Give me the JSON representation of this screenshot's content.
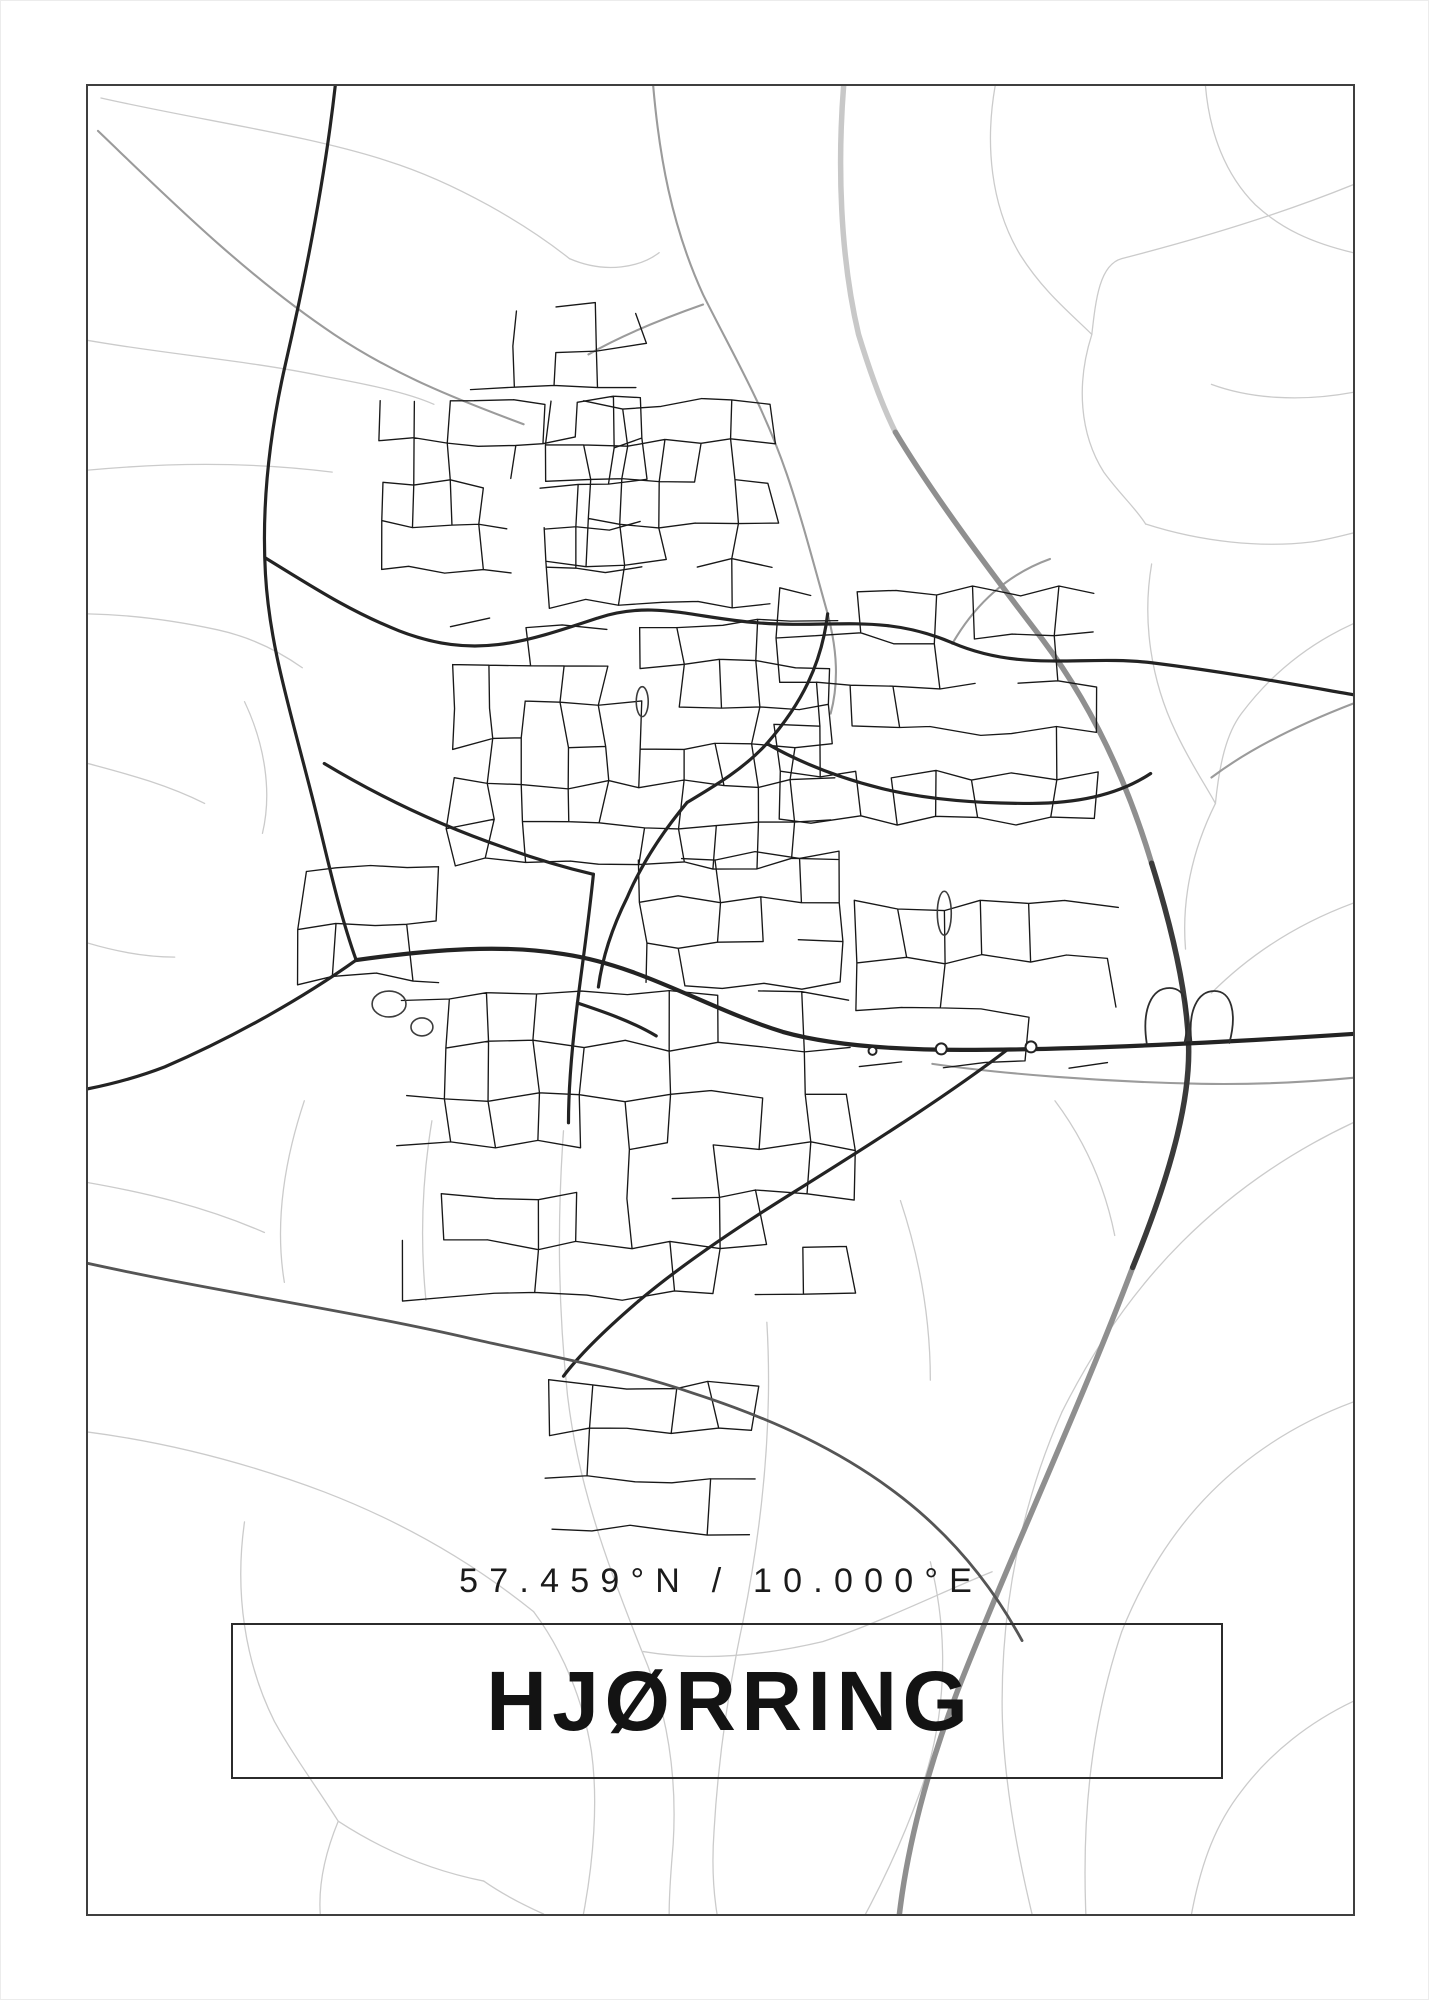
{
  "poster": {
    "title": "HJØRRING",
    "coordinates": "57.459°N / 10.000°E",
    "colors": {
      "background": "#ffffff",
      "frame_border": "#3f3f3f",
      "title_box_border": "#2b2b2b",
      "title_text": "#131313",
      "coordinates_text": "#1b1b1b",
      "road_faint": "#cbcbcb",
      "road_medium": "#9b9b9b",
      "road_dark": "#232323",
      "motorway_dark": "#3a3a3a"
    },
    "map": {
      "viewbox": "85 83 1269 1832",
      "layers": [
        {
          "name": "rural-faint",
          "color": "#cbcbcb",
          "width": 1.3,
          "paths": [
            "M98,95 C200,118 305,132 385,158 C455,180 525,222 568,256",
            "M568,256 C605,272 640,264 658,250",
            "M85,338 C165,352 245,358 322,374 C365,382 405,390 432,402",
            "M85,468 C170,460 252,460 330,470",
            "M85,612 C135,613 178,620 215,628 C252,636 280,652 300,666",
            "M242,700 C262,742 270,790 260,832",
            "M85,762 C122,772 162,782 202,802",
            "M995,83 C985,140 990,202 1020,252 C1044,290 1072,312 1092,332",
            "M1354,182 C1280,212 1200,236 1122,256 C1100,262 1096,296 1092,332",
            "M1092,332 C1076,382 1080,432 1104,470 C1120,492 1136,506 1146,522",
            "M1206,83 C1210,130 1226,172 1256,202 C1282,226 1312,240 1354,250",
            "M1354,390 C1300,400 1250,396 1212,382",
            "M1146,522 C1202,540 1262,546 1312,540 C1327,538 1342,534 1354,531",
            "M1152,562 C1142,620 1152,680 1176,730 C1190,760 1205,782 1216,802",
            "M1354,622 C1310,642 1272,672 1242,712 C1227,732 1220,762 1216,802",
            "M1216,802 C1192,850 1182,900 1186,948",
            "M302,1100 C282,1160 272,1222 282,1282",
            "M85,1182 C142,1192 202,1206 262,1232",
            "M85,1432 C162,1442 242,1462 322,1492 C400,1522 470,1562 532,1612",
            "M242,1522 C232,1592 242,1662 272,1722 C292,1758 316,1790 336,1822",
            "M336,1822 C382,1852 432,1872 482,1882 M336,1822 C322,1856 316,1886 318,1915",
            "M532,1612 C562,1652 582,1702 590,1752 C597,1802 592,1862 582,1915",
            "M482,1882 C502,1896 522,1906 542,1915",
            "M562,1130 C556,1215 556,1300 566,1395 C576,1480 602,1555 640,1650",
            "M640,1650 C668,1715 676,1780 672,1845 C670,1868 668,1892 668,1915",
            "M766,1322 C772,1422 762,1522 742,1622 C727,1692 717,1762 713,1832 C711,1860 712,1890 716,1915",
            "M1354,902 C1300,922 1252,952 1212,992",
            "M1354,1122 C1290,1152 1232,1192 1182,1242 C1132,1292 1092,1352 1062,1412",
            "M1062,1412 C1022,1502 1002,1602 1002,1702 C1002,1762 1012,1832 1032,1915",
            "M1354,1402 C1300,1422 1252,1452 1212,1492 C1172,1532 1142,1582 1122,1632",
            "M1122,1632 C1092,1722 1082,1812 1086,1915",
            "M1354,1702 C1312,1722 1272,1752 1242,1792 C1217,1824 1202,1862 1192,1915",
            "M642,1652 C702,1662 762,1656 822,1642 C882,1622 942,1592 992,1572",
            "M85,942 C112,950 142,956 172,956",
            "M430,1120 C420,1180 418,1240 424,1300",
            "M900,1200 C920,1260 930,1320 930,1380",
            "M1055,1100 C1085,1140 1105,1185 1115,1235",
            "M930,1562 C950,1642 945,1722 920,1792 C900,1847 880,1887 865,1915"
          ]
        },
        {
          "name": "connector-medium",
          "color": "#9b9b9b",
          "width": 2.1,
          "paths": [
            "M652,83 C658,152 670,222 702,292 C732,352 762,402 786,472 C801,516 813,562 827,612 C837,650 838,682 830,712",
            "M95,128 C162,192 242,272 332,332 C392,372 452,396 522,422",
            "M1354,702 C1302,722 1252,746 1212,776",
            "M932,1063 C1002,1073 1102,1081 1202,1083 C1262,1084 1312,1081 1354,1077",
            "M702,302 C662,316 622,332 587,352",
            "M952,642 C975,602 1008,572 1050,557"
          ]
        },
        {
          "name": "motorway-light",
          "color": "#c8c8c8",
          "width": 5.5,
          "paths": [
            "M843,83 C837,160 839,252 858,332 C869,368 881,402 895,430"
          ]
        },
        {
          "name": "motorway-mid",
          "color": "#8f8f8f",
          "width": 5.5,
          "paths": [
            "M895,430 C932,492 992,572 1042,637 C1082,690 1122,762 1152,862",
            "M1133,1267 C1082,1402 1012,1552 957,1692 C927,1770 907,1847 899,1915"
          ]
        },
        {
          "name": "residential-streets",
          "color": "#181818",
          "width": 1.35,
          "clusters": [
            {
              "x": 378,
              "y": 398,
              "w": 265,
              "h": 168,
              "rows": 4,
              "cols": 8,
              "seed": 11
            },
            {
              "x": 548,
              "y": 402,
              "w": 225,
              "h": 200,
              "rows": 5,
              "cols": 6,
              "seed": 22
            },
            {
              "x": 448,
              "y": 622,
              "w": 385,
              "h": 240,
              "rows": 6,
              "cols": 10,
              "seed": 33
            },
            {
              "x": 775,
              "y": 590,
              "w": 320,
              "h": 230,
              "rows": 5,
              "cols": 8,
              "seed": 44
            },
            {
              "x": 400,
              "y": 995,
              "w": 450,
              "h": 300,
              "rows": 6,
              "cols": 10,
              "seed": 55
            },
            {
              "x": 858,
              "y": 905,
              "w": 255,
              "h": 158,
              "rows": 3,
              "cols": 6,
              "seed": 66
            },
            {
              "x": 548,
              "y": 1385,
              "w": 205,
              "h": 145,
              "rows": 3,
              "cols": 5,
              "seed": 77
            },
            {
              "x": 300,
              "y": 868,
              "w": 140,
              "h": 110,
              "rows": 2,
              "cols": 4,
              "seed": 88
            },
            {
              "x": 640,
              "y": 855,
              "w": 200,
              "h": 130,
              "rows": 3,
              "cols": 5,
              "seed": 99
            },
            {
              "x": 470,
              "y": 305,
              "w": 170,
              "h": 80,
              "rows": 2,
              "cols": 4,
              "seed": 10
            }
          ]
        },
        {
          "name": "motorway-dark",
          "color": "#3a3a3a",
          "width": 5.5,
          "paths": [
            "M1152,862 C1174,932 1187,992 1189,1042 C1191,1092 1176,1162 1133,1267"
          ]
        },
        {
          "name": "main-roads",
          "color": "#232323",
          "width": 3.2,
          "paths": [
            "M333,83 C323,172 306,262 283,362 C267,432 259,502 263,572 C267,642 286,702 309,792 C323,846 335,906 354,959",
            "M354,959 C302,996 232,1036 162,1066 C136,1076 110,1083 85,1088",
            "M263,556 C312,586 347,609 397,629 C472,658 522,641 597,616 C652,598 692,616 757,621 C832,627 882,611 952,641 C1022,671 1082,653 1152,661 C1232,671 1302,684 1354,693",
            "M827,612 C821,662 801,702 766,742 C741,769 711,786 686,801",
            "M322,762 C372,792 432,822 502,846 C532,857 562,866 592,873",
            "M1007,1049 C952,1091 882,1136 802,1186 C742,1223 682,1263 637,1301",
            "M637,1301 C602,1331 577,1356 562,1376",
            "M592,873 C587,922 581,962 576,1002 C571,1042 567,1082 567,1122",
            "M686,801 C661,831 641,861 626,896 C611,926 601,956 597,986",
            "M766,742 C801,762 841,777 881,787 C931,799 981,802 1031,802",
            "M1031,802 C1081,802 1121,792 1151,772",
            "M576,1002 C600,1010 630,1020 655,1035"
          ]
        },
        {
          "name": "primary-road",
          "color": "#232323",
          "width": 4.2,
          "paths": [
            "M354,959 C432,948 502,943 562,953 C642,965 702,1006 782,1031 C832,1045 902,1049 962,1049 C1062,1049 1202,1043 1354,1033"
          ]
        },
        {
          "name": "ring-south",
          "color": "#555555",
          "width": 2.8,
          "paths": [
            "M85,1263 C222,1293 352,1311 472,1339 C562,1359 622,1369 692,1393 C772,1419 842,1451 902,1498 C952,1537 992,1586 1022,1641"
          ]
        },
        {
          "name": "interchange-ramps",
          "color": "#2e2e2e",
          "width": 1.8,
          "paths": [
            "M1147,1042 C1142,1008 1152,987 1170,987 C1187,987 1192,1007 1185,1042",
            "M1192,1042 C1188,1010 1198,990 1215,990 C1232,990 1238,1012 1230,1042"
          ]
        },
        {
          "name": "landmarks",
          "color": "#3c3c3c",
          "width": 1.6,
          "ellipses": [
            [
              387,
              1003,
              17,
              13
            ],
            [
              420,
              1026,
              11,
              9
            ],
            [
              944,
              912,
              7,
              22
            ],
            [
              641,
              700,
              6,
              15
            ]
          ]
        },
        {
          "name": "roundabouts",
          "color": "#232323",
          "width": 2,
          "fill": "#ffffff",
          "ellipses": [
            [
              941,
              1048,
              5.5,
              5.5
            ],
            [
              1031,
              1046,
              5.5,
              5.5
            ],
            [
              872,
              1050,
              4,
              4
            ]
          ]
        }
      ]
    }
  }
}
